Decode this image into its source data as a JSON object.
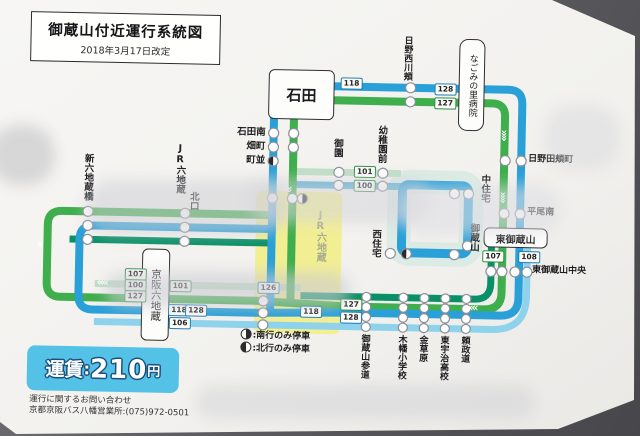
{
  "title": {
    "heading": "御蔵山付近運行系統図",
    "revision": "2018年3月17日改定"
  },
  "fare": {
    "label": "運賃",
    "separator": ":",
    "amount": "210",
    "unit": "円"
  },
  "contact": {
    "line1": "運行に関するお問い合わせ",
    "line2": "京都京阪バス八幡営業所:(075)972-0501"
  },
  "legend": {
    "southbound": ":南行のみ停車",
    "northbound": ":北行のみ停車",
    "south_icon": "half-filled-circle-right",
    "north_icon": "half-filled-circle-left"
  },
  "stations": {
    "ishida": "石田",
    "ishida_minami": "石田南",
    "hatamachi": "畑町",
    "machinami": "町並",
    "shin_rokujizobashi": "新六地蔵橋",
    "jr_rokujizo": "JR六地蔵",
    "kitaguchi": "北口",
    "keihan_rokujizo": "京阪六地蔵",
    "jr_rokujizo_highlight": "JR六地蔵",
    "misono": "御園",
    "yochien_mae": "幼稚園前",
    "hino_nishikawazura": "日野西川頬",
    "nagomi_hospital": "なごみの里病院",
    "hino_tazuramachi": "日野田頬町",
    "hirao_minami": "平尾南",
    "naka_jutaku": "中住宅",
    "mikurayama": "御蔵山",
    "nishi_jutaku": "西住宅",
    "higashi_mikurayama": "東御蔵山",
    "higashi_mikurayama_chuo": "東御蔵山中央",
    "mikurayama_sando": "御蔵山参道",
    "kohata_elementary": "木幡小学校",
    "kanekusahara": "金草原",
    "higashi_uji_highschool": "東宇治高校",
    "yorimasamichi": "頼政道"
  },
  "badges": {
    "t118": "118",
    "t128": "128",
    "t127": "127",
    "m101": "101",
    "m100": "100",
    "c126": "126",
    "c118": "118",
    "c127": "127",
    "c128": "128",
    "l107": "107",
    "l100": "100",
    "l127": "127",
    "l101": "101",
    "l118": "118",
    "l128": "128",
    "l106": "106",
    "r107": "107",
    "r108": "108"
  },
  "colors": {
    "line_blue": "#2aa0d8",
    "line_green": "#3fae4c",
    "line_teal": "#0a9066",
    "line_light_blue": "#8fd2ec",
    "line_pale_green": "#bfdfc6",
    "line_cyan": "#57b1d5",
    "highlight_yellow": "#f2ef92",
    "fare_bg": "#54c2e7",
    "badge_green": "#2f8f43",
    "badge_blue": "#1d7fb5"
  }
}
